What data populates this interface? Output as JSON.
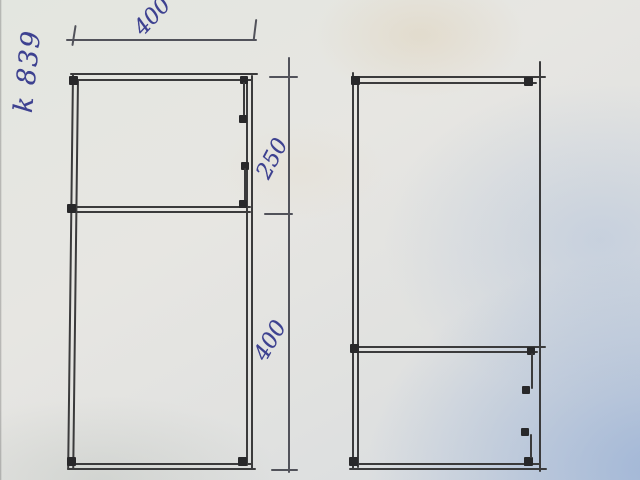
{
  "sketch": {
    "part_label": "k 839",
    "dimensions": {
      "top_width": "400",
      "upper_height": "250",
      "lower_height": "400"
    }
  },
  "colors": {
    "ink_blue": "#3d4190",
    "pencil_dark": "#3b3b3c",
    "paper_light": "#e5e6e1",
    "paper_shadow_blue": "#b7c6dc"
  }
}
